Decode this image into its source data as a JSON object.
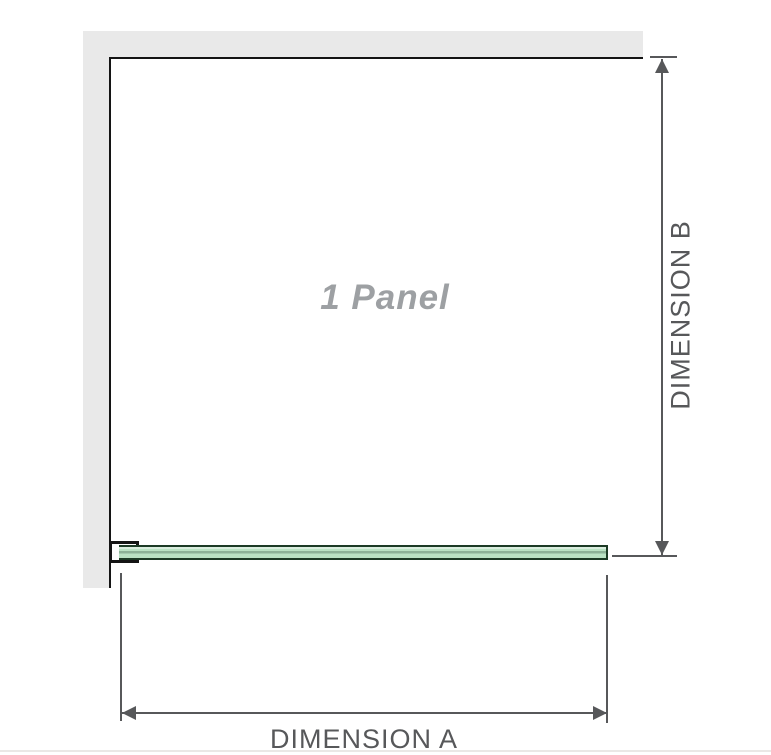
{
  "diagram": {
    "panel_count_label": "1 Panel",
    "dimensions": {
      "vertical": "DIMENSION B",
      "horizontal": "DIMENSION A"
    },
    "colors": {
      "wall": "#e9e9e9",
      "outline": "#141414",
      "glass-fill": "#b9e2c3",
      "glass-light": "#d9edde",
      "glass-stripe": "#8cb297",
      "glass-edge": "#1c3a25",
      "dim": "#57585a",
      "label": "#9da0a3",
      "separator": "#eae8e6"
    }
  }
}
